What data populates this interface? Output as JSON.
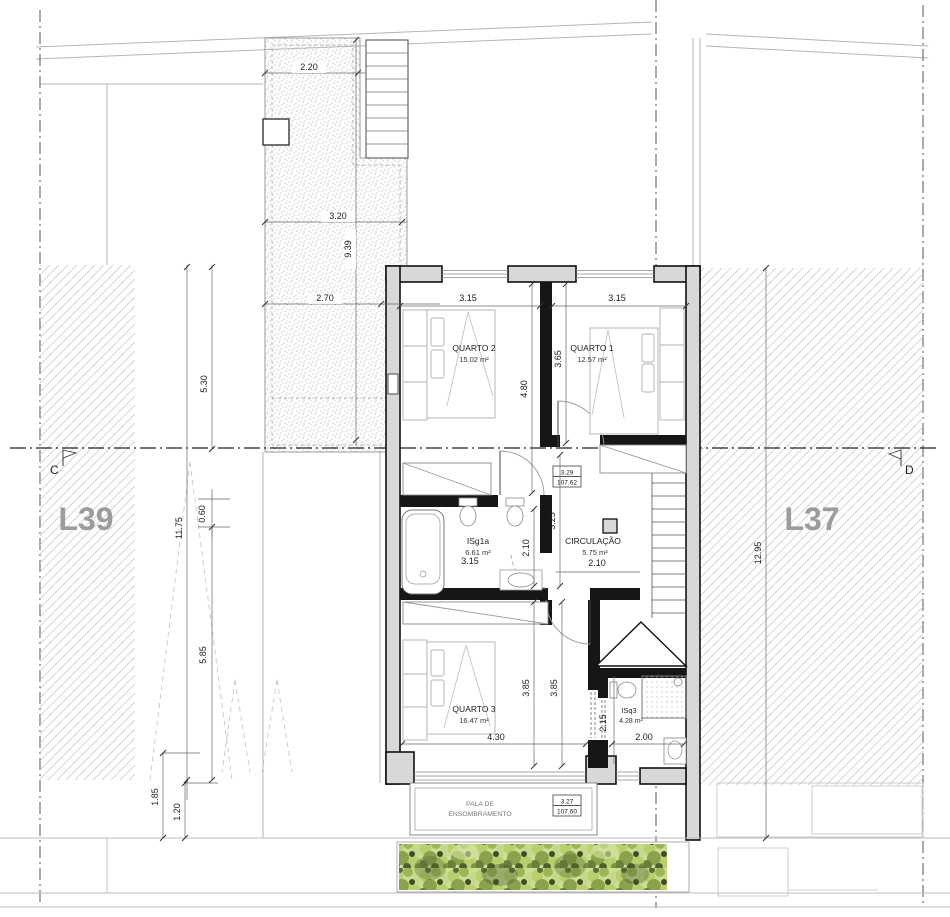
{
  "lots": {
    "left": "L39",
    "right": "L37"
  },
  "section_markers": {
    "left": "C",
    "right": "D"
  },
  "rooms": {
    "quarto2": {
      "name": "QUARTO 2",
      "area": "15.02 m²",
      "width": "3.15",
      "height": "4.80"
    },
    "quarto1": {
      "name": "QUARTO 1",
      "area": "12.57 m²",
      "width": "3.15",
      "height": "3.65"
    },
    "isg1a": {
      "name": "ISg1a",
      "area": "6.61 m²",
      "width": "3.15",
      "height": "2.10"
    },
    "circulacao": {
      "name": "CIRCULAÇÃO",
      "area": "5.75 m²",
      "width": "2.10",
      "height": "3.25"
    },
    "quarto3": {
      "name": "QUARTO 3",
      "area": "16.47 m²",
      "width": "4.30",
      "height_a": "3.85",
      "height_b": "3.85"
    },
    "isq3": {
      "name": "ISq3",
      "area": "4.28 m²",
      "width": "2.00",
      "height": "2.15"
    },
    "pala": {
      "line1": "PALA DE",
      "line2": "ENSOMBRAMENTO"
    }
  },
  "levels": {
    "upper": {
      "value": "3.29",
      "elevation": "107.62"
    },
    "lower": {
      "value": "3.27",
      "elevation": "107.60"
    }
  },
  "site_dims": {
    "patio_top": "2.20",
    "patio_mid": "3.20",
    "patio_depth": "9.39",
    "patio_low": "2.70",
    "left_upper": "5.30",
    "left_total": "11.75",
    "left_offset": "0.60",
    "left_lower": "5.85",
    "bottom_a": "1.85",
    "bottom_b": "1.20",
    "right_total": "12.95"
  },
  "colors": {
    "wall_fill": "#d8d8d8",
    "wall_line": "#111111",
    "lot_hatch": "#cccccc",
    "hedge_light": "#bed47e",
    "hedge_dark": "#55662f",
    "lot_label": "#9c9c9c"
  }
}
